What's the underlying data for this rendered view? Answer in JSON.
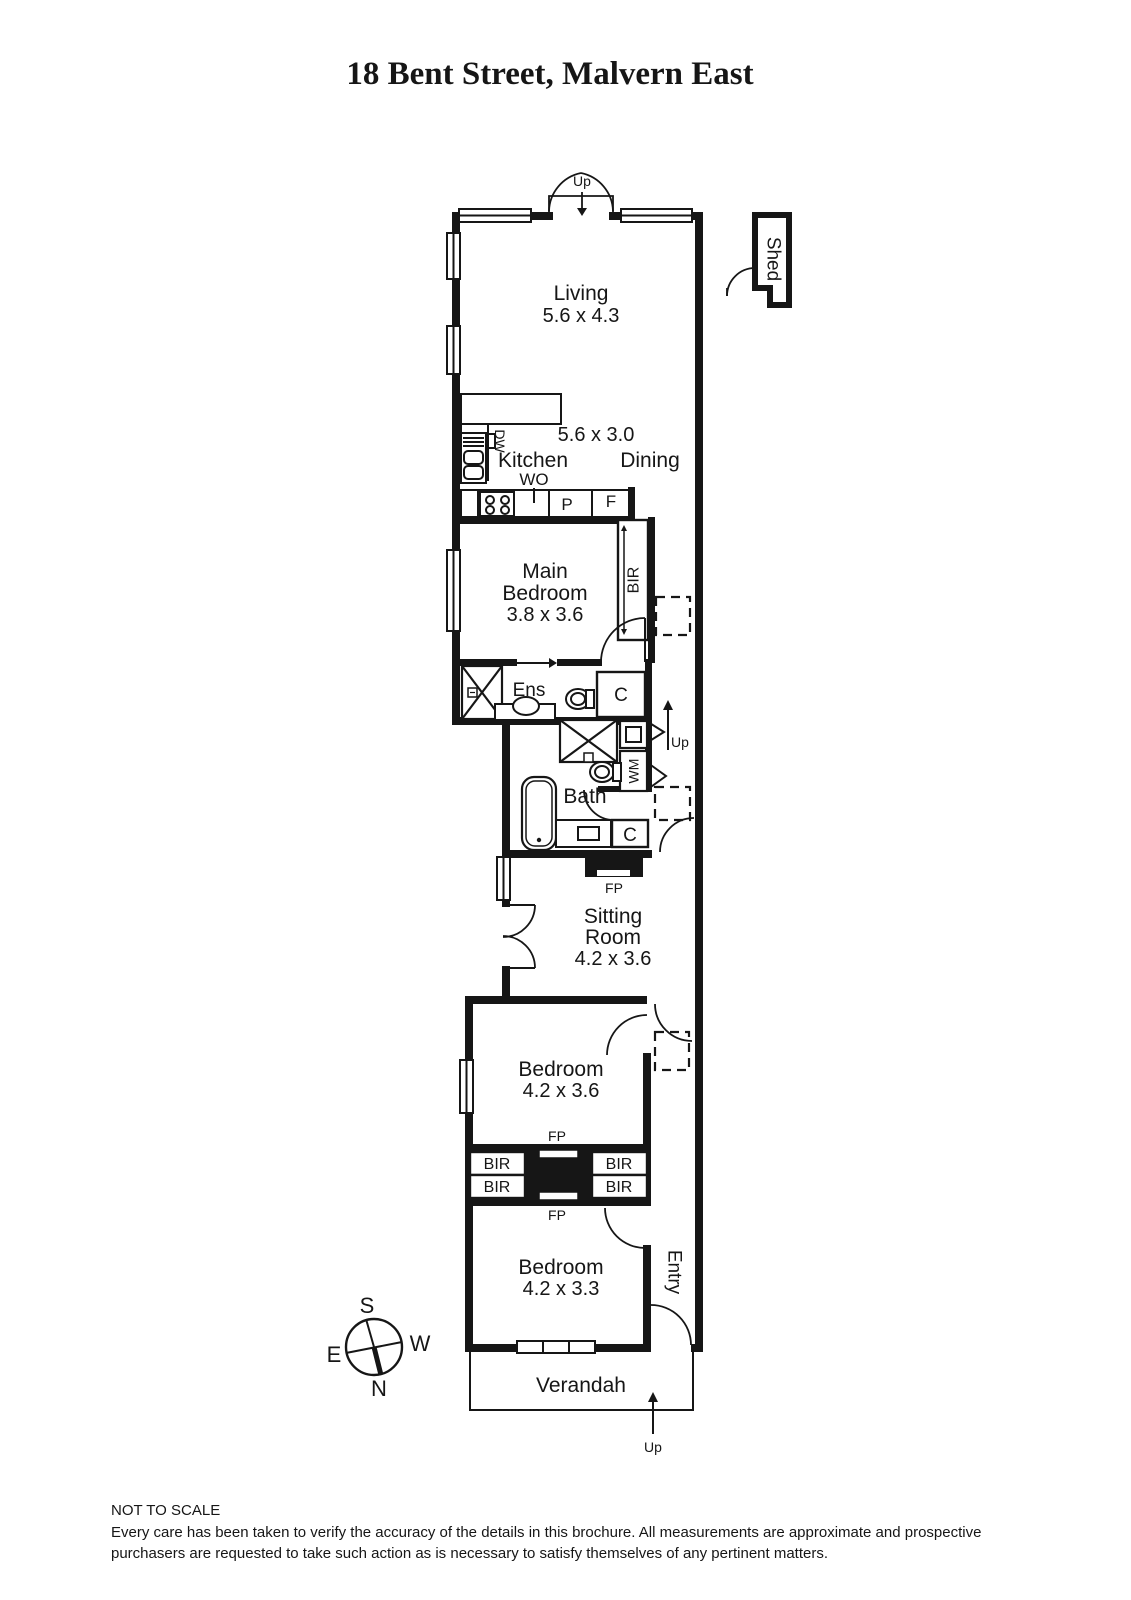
{
  "title": "18 Bent Street, Malvern East",
  "plan": {
    "up_label": "Up",
    "rooms": {
      "living": {
        "name": "Living",
        "dims": "5.6 x 4.3"
      },
      "kitchen_dining": {
        "dims": "5.6 x 3.0",
        "kitchen": "Kitchen",
        "dining": "Dining"
      },
      "main_bedroom": {
        "line1": "Main",
        "line2": "Bedroom",
        "dims": "3.8 x 3.6"
      },
      "ensuite": {
        "name": "Ens"
      },
      "bath": {
        "name": "Bath"
      },
      "sitting_room": {
        "line1": "Sitting",
        "line2": "Room",
        "dims": "4.2 x 3.6"
      },
      "bedroom_2": {
        "name": "Bedroom",
        "dims": "4.2 x 3.6"
      },
      "bedroom_3": {
        "name": "Bedroom",
        "dims": "4.2 x 3.3"
      },
      "entry": {
        "name": "Entry"
      },
      "verandah": {
        "name": "Verandah"
      },
      "shed": {
        "name": "Shed"
      }
    },
    "fixtures": {
      "dishwasher": "DW",
      "wall_oven": "WO",
      "pantry": "P",
      "fridge": "F",
      "built_in_robe": "BIR",
      "cupboard": "C",
      "washing_machine": "WM",
      "fireplace": "FP"
    },
    "compass": {
      "north": "N",
      "south": "S",
      "east": "E",
      "west": "W"
    }
  },
  "footer": {
    "not_to_scale": "NOT TO SCALE",
    "disclaimer": "Every care has been taken to verify the accuracy of the details in this brochure. All measurements are approximate and prospective purchasers are requested to take such action as is necessary to satisfy themselves of any pertinent matters."
  }
}
